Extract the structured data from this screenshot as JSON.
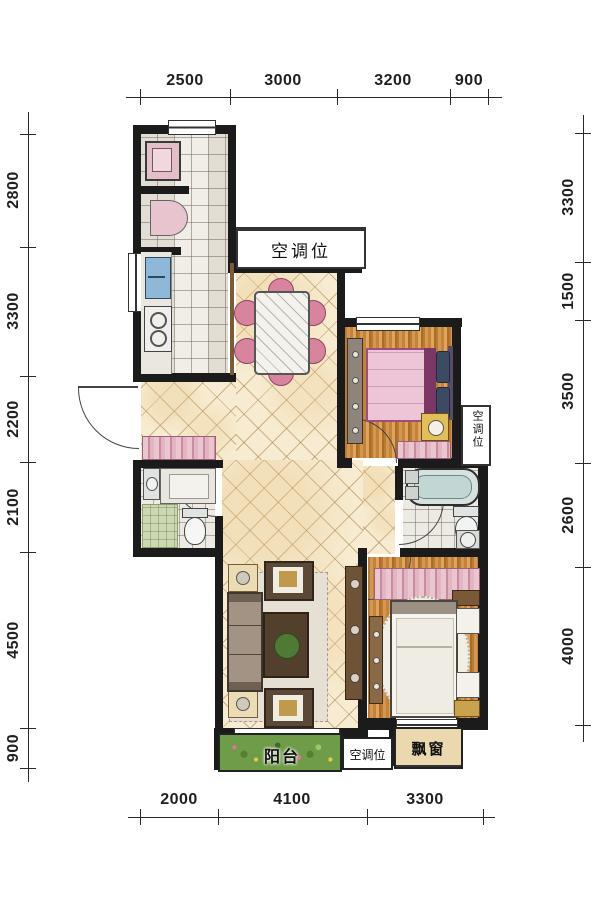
{
  "plan": {
    "labels": {
      "ac_top": "空调位",
      "ac_right": "空调位",
      "ac_bottom": "空调位",
      "balcony": "阳台",
      "bay_window": "飘窗"
    },
    "dims": {
      "top": [
        "2500",
        "3000",
        "3200",
        "900"
      ],
      "bottom": [
        "2000",
        "4100",
        "3300"
      ],
      "left": [
        "2800",
        "3300",
        "2200",
        "2100",
        "4500",
        "900"
      ],
      "right": [
        "3300",
        "1500",
        "3500",
        "2600",
        "4000"
      ]
    },
    "colors": {
      "wall": "#1b1b1b",
      "marble_floor": "#f7ecd2",
      "wood_floor": "#cf9148",
      "tile_floor": "#f1eee7",
      "chair_pink": "#d9849f",
      "bed_blanket_pink": "#eec5d6",
      "pillow_navy": "#3c4a64",
      "balcony_green": "#6f9c48",
      "bay_window_tan": "#ecd8ae"
    }
  }
}
